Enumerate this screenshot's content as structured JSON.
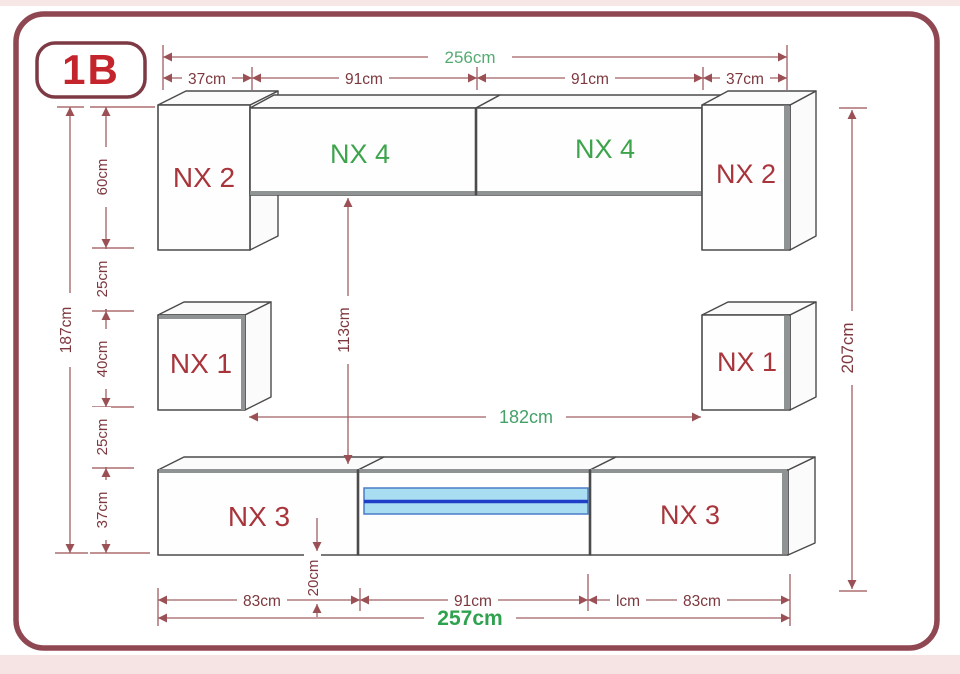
{
  "page": {
    "badge": "1B"
  },
  "colors": {
    "page_border": "#8f4752",
    "badge_text": "#c4242b",
    "dim_text": "#7d383e",
    "dim_line": "#a06065",
    "red_label": "#a8353c",
    "green_label": "#3da44c",
    "green_dim": "#55ab72",
    "green_total": "#2fa24f",
    "shelf_fill": "#a9ddf1",
    "shelf_line": "#1f3ec9"
  },
  "cabinets": {
    "nx2_left": "NX 2",
    "nx4_left": "NX 4",
    "nx4_right": "NX 4",
    "nx2_right": "NX 2",
    "nx1_left": "NX 1",
    "nx1_right": "NX 1",
    "nx3_left": "NX 3",
    "nx3_right": "NX 3"
  },
  "dims": {
    "top_total": "256cm",
    "top": [
      "37cm",
      "91cm",
      "91cm",
      "37cm"
    ],
    "left_total": "187cm",
    "left": [
      "60cm",
      "25cm",
      "40cm",
      "25cm",
      "37cm"
    ],
    "center_height": "113cm",
    "center_span": "182cm",
    "right_total": "207cm",
    "bottom": [
      "83cm",
      "91cm",
      "lcm",
      "83cm"
    ],
    "bottom_offset": "20cm",
    "bottom_total": "257cm"
  }
}
